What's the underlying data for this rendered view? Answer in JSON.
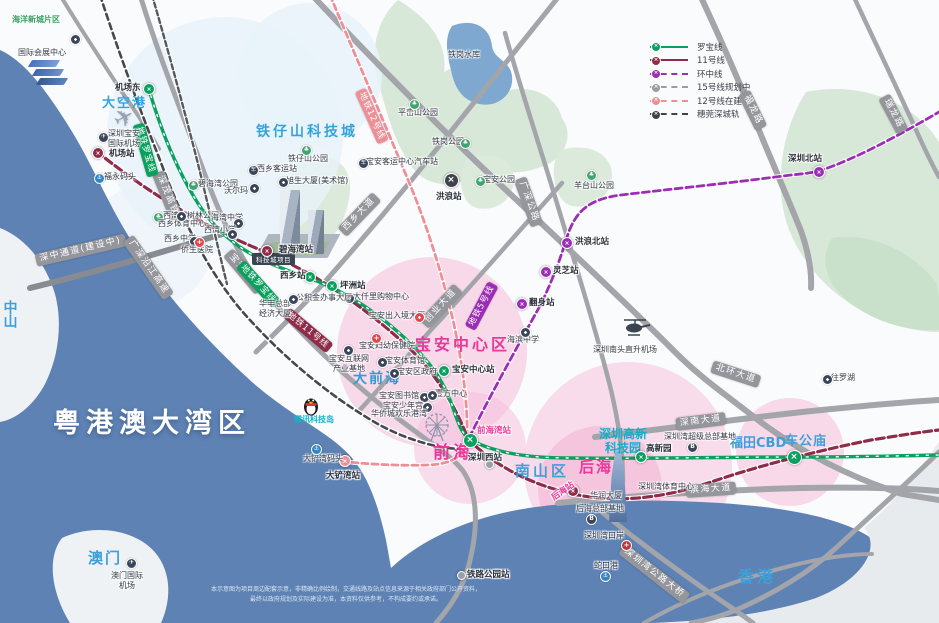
{
  "colors": {
    "sea": "#5E82B4",
    "land": "#FAFBFC",
    "terrain_green": "#D8E8D8",
    "lake": "#7FA8D0",
    "pink_zone": "#F5BEDB",
    "glow_blue": "#E9F2FA",
    "road_gray": "#A3A5AB",
    "line_colors": {
      "G": "#0BA05F",
      "M": "#8E2C49",
      "P": "#9C2EB5",
      "S": "#ED8F97",
      "D": "#3F434B",
      "R": "#9BA0A8"
    }
  },
  "legend": {
    "items": [
      {
        "label": "罗宝线",
        "color": "#0BA05F",
        "dash": "solid"
      },
      {
        "label": "11号线",
        "color": "#8E2C49",
        "dash": "solid"
      },
      {
        "label": "环中线",
        "color": "#9C2EB5",
        "dash": "dashed"
      },
      {
        "label": "15号线规划中",
        "color": "#9A9CA2",
        "dash": "dashed"
      },
      {
        "label": "12号线在建中",
        "color": "#ED8F97",
        "dash": "dashed"
      },
      {
        "label": "穗莞深城轨",
        "color": "#3F4248",
        "dash": "dashed"
      }
    ]
  },
  "areas": [
    {
      "t": "海洋新城片区",
      "x": 12,
      "y": 15,
      "s": 8,
      "c": "#3AA065"
    },
    {
      "t": "大空港",
      "x": 102,
      "y": 96,
      "s": 13,
      "c": "#35A3DB",
      "ls": 2
    },
    {
      "t": "铁仔山科技城",
      "x": 256,
      "y": 124,
      "s": 14,
      "c": "#35A3DB",
      "ls": 3
    },
    {
      "t": "宝安中心区",
      "x": 415,
      "y": 336,
      "s": 16,
      "c": "#E9399A",
      "ls": 3
    },
    {
      "t": "大前海",
      "x": 353,
      "y": 371,
      "s": 14,
      "c": "#2F9BD8",
      "ls": 2
    },
    {
      "t": "前海",
      "x": 433,
      "y": 443,
      "s": 17,
      "c": "#E9399A",
      "ls": 3
    },
    {
      "t": "南山区",
      "x": 515,
      "y": 463,
      "s": 15,
      "c": "#3FA0D8",
      "ls": 3
    },
    {
      "t": "后海",
      "x": 579,
      "y": 459,
      "s": 15,
      "c": "#E9399A",
      "ls": 2
    },
    {
      "t": "深圳高新\n科技园",
      "x": 599,
      "y": 427,
      "s": 12,
      "c": "#12AECB",
      "ctr": 1
    },
    {
      "t": "福田CBD",
      "x": 730,
      "y": 436,
      "s": 13,
      "c": "#3FA0D8"
    },
    {
      "t": "车公庙",
      "x": 785,
      "y": 434,
      "s": 13,
      "c": "#3FA0D8",
      "ls": 1
    },
    {
      "t": "香港",
      "x": 738,
      "y": 568,
      "s": 16,
      "c": "#3FA0D8",
      "ls": 3
    },
    {
      "t": "澳门",
      "x": 88,
      "y": 550,
      "s": 15,
      "c": "#3FA0D8",
      "ls": 2
    },
    {
      "t": "中山",
      "x": 1,
      "y": 300,
      "s": 14,
      "c": "#3FA0D8",
      "v": 1
    },
    {
      "t": "粤港澳大湾区",
      "x": 53,
      "y": 408,
      "s": 27,
      "c": "#FFFFFF",
      "ls": 6,
      "sh": 1
    },
    {
      "t": "腾讯科技岛",
      "x": 294,
      "y": 415,
      "s": 8,
      "c": "#17B2CC"
    }
  ],
  "road_labels": [
    {
      "t": "深中通道(建设中)",
      "x": 36,
      "y": 254,
      "r": -13
    },
    {
      "t": "广深沿江高速",
      "x": 128,
      "y": 232,
      "r": 55
    },
    {
      "t": "深茂高铁",
      "x": 158,
      "y": 166,
      "r": 68
    },
    {
      "t": "宝安大道",
      "x": 228,
      "y": 246,
      "r": 50
    },
    {
      "t": "西乡大道",
      "x": 342,
      "y": 226,
      "r": -46
    },
    {
      "t": "创业大道",
      "x": 424,
      "y": 318,
      "r": -47
    },
    {
      "t": "广深公路",
      "x": 520,
      "y": 172,
      "r": 70
    },
    {
      "t": "北环大道",
      "x": 712,
      "y": 360,
      "r": 18
    },
    {
      "t": "深南大道",
      "x": 676,
      "y": 418,
      "r": -7
    },
    {
      "t": "滨海大道",
      "x": 686,
      "y": 485,
      "r": -4
    },
    {
      "t": "福龙路",
      "x": 744,
      "y": 86,
      "r": 64
    },
    {
      "t": "瑞龙路",
      "x": 884,
      "y": 90,
      "r": 62
    },
    {
      "t": "深圳湾公路大桥",
      "x": 622,
      "y": 542,
      "r": 38
    }
  ],
  "metro_tags": [
    {
      "t": "地铁罗宝线",
      "x": 138,
      "y": 118,
      "r": 74,
      "c": "#0BA05F"
    },
    {
      "t": "地铁罗宝线",
      "x": 240,
      "y": 258,
      "r": 48,
      "c": "#0BA05F"
    },
    {
      "t": "地铁11号线",
      "x": 286,
      "y": 306,
      "r": 40,
      "c": "#8E2C49"
    },
    {
      "t": "地铁12号线",
      "x": 360,
      "y": 84,
      "r": 66,
      "c": "#ED8F97"
    },
    {
      "t": "地铁5号线",
      "x": 470,
      "y": 322,
      "r": -62,
      "c": "#9C2EB5"
    }
  ],
  "stations": [
    {
      "t": "机场东",
      "x": 148,
      "y": 88,
      "k": "G",
      "lx": 115,
      "ly": 81
    },
    {
      "t": "机场站",
      "x": 97,
      "y": 152,
      "k": "M",
      "lx": 109,
      "ly": 147
    },
    {
      "t": "碧海湾站",
      "x": 266,
      "y": 250,
      "k": "M",
      "lx": 279,
      "ly": 243
    },
    {
      "t": "西乡站",
      "x": 309,
      "y": 276,
      "k": "G",
      "lx": 280,
      "ly": 269
    },
    {
      "t": "坪洲站",
      "x": 331,
      "y": 285,
      "k": "G",
      "lx": 340,
      "ly": 279
    },
    {
      "t": "宝安中心站",
      "x": 443,
      "y": 370,
      "k": "G",
      "lx": 452,
      "ly": 363
    },
    {
      "t": "前海湾站",
      "x": 469,
      "y": 439,
      "k": "G",
      "big": 1,
      "lx": 477,
      "ly": 424,
      "lc": "#E9399A"
    },
    {
      "t": "高新园",
      "x": 640,
      "y": 456,
      "k": "G",
      "lx": 646,
      "ly": 442
    },
    {
      "t": "",
      "x": 793,
      "y": 456,
      "k": "G",
      "big": 1
    },
    {
      "t": "深圳北站",
      "x": 818,
      "y": 171,
      "k": "P",
      "lx": 788,
      "ly": 152
    },
    {
      "t": "后海站",
      "x": 572,
      "y": 490,
      "k": "M",
      "lx": 552,
      "ly": 492,
      "lc": "#E9399A",
      "lr": -35
    },
    {
      "t": "深圳西站",
      "x": 488,
      "y": 463,
      "k": "R",
      "lx": 468,
      "ly": 451
    },
    {
      "t": "洪浪北站",
      "x": 566,
      "y": 242,
      "k": "P",
      "lx": 575,
      "ly": 235
    },
    {
      "t": "灵芝站",
      "x": 545,
      "y": 271,
      "k": "P",
      "lx": 553,
      "ly": 264
    },
    {
      "t": "翻身站",
      "x": 521,
      "y": 303,
      "k": "P",
      "lx": 529,
      "ly": 296
    },
    {
      "t": "洪浪站",
      "x": 450,
      "y": 179,
      "k": "D",
      "big": 1,
      "lx": 436,
      "ly": 190
    },
    {
      "t": "大铲湾站",
      "x": 344,
      "y": 460,
      "k": "S",
      "lx": 326,
      "ly": 469
    },
    {
      "t": "铁路公园站",
      "x": 460,
      "y": 574,
      "k": "R",
      "lx": 467,
      "ly": 568
    }
  ],
  "pois": [
    {
      "t": "国际会展中心",
      "x": 18,
      "y": 48,
      "i": "dot",
      "ix": 70,
      "iy": 34
    },
    {
      "t": "深圳宝安\n国际机场",
      "x": 108,
      "y": 129,
      "ctr": 1,
      "i": "star",
      "ix": 98,
      "iy": 132
    },
    {
      "i": "plane",
      "ix": 114,
      "iy": 104
    },
    {
      "t": "福永码头",
      "x": 104,
      "y": 172,
      "i": "anchor",
      "ix": 94,
      "iy": 173
    },
    {
      "t": "碧海湾公园",
      "x": 198,
      "y": 179,
      "i": "park",
      "ix": 188,
      "iy": 180
    },
    {
      "t": "沃尔玛",
      "x": 224,
      "y": 186,
      "i": "dot",
      "ix": 249,
      "iy": 183
    },
    {
      "t": "西湾红树林公园",
      "x": 163,
      "y": 211,
      "i": "park",
      "ix": 153,
      "iy": 212
    },
    {
      "t": "海湾中学",
      "x": 211,
      "y": 213,
      "i": "dot",
      "ix": 233,
      "iy": 218
    },
    {
      "t": "西湾小学",
      "x": 204,
      "y": 225,
      "i": "dot",
      "ix": 227,
      "iy": 229
    },
    {
      "t": "西乡体育中心",
      "x": 158,
      "y": 219,
      "i": "dot",
      "ix": 176,
      "iy": 211
    },
    {
      "t": "西乡中学",
      "x": 164,
      "y": 234,
      "i": "dot",
      "ix": 189,
      "iy": 236
    },
    {
      "t": "侨生医院",
      "x": 181,
      "y": 245,
      "i": "hosp",
      "ix": 194,
      "iy": 237
    },
    {
      "t": "西乡客运站",
      "x": 257,
      "y": 164,
      "i": "bus",
      "ix": 248,
      "iy": 165
    },
    {
      "t": "旭生大厦(美术馆)",
      "x": 286,
      "y": 176,
      "i": "dot",
      "ix": 278,
      "iy": 177
    },
    {
      "t": "铁仔山公园",
      "x": 288,
      "y": 154,
      "i": "park",
      "ix": 301,
      "iy": 145
    },
    {
      "t": "平峦山公园",
      "x": 398,
      "y": 108,
      "i": "park",
      "ix": 409,
      "iy": 99
    },
    {
      "t": "铁岗公园",
      "x": 432,
      "y": 137,
      "i": "park",
      "ix": 460,
      "iy": 138
    },
    {
      "t": "铁岗水库",
      "x": 448,
      "y": 50
    },
    {
      "t": "宝安公园",
      "x": 483,
      "y": 175,
      "i": "park",
      "ix": 475,
      "iy": 176
    },
    {
      "t": "羊台山公园",
      "x": 574,
      "y": 181,
      "i": "park",
      "ix": 586,
      "iy": 170
    },
    {
      "t": "宝安客运中心汽车站",
      "x": 366,
      "y": 157,
      "i": "bus",
      "ix": 358,
      "iy": 158
    },
    {
      "t": "大仟里购物中心",
      "x": 353,
      "y": 292,
      "i": "dot",
      "ix": 344,
      "iy": 293
    },
    {
      "t": "宝安出入境大厅",
      "x": 369,
      "y": 311,
      "i": "reddot",
      "ix": 414,
      "iy": 312
    },
    {
      "t": "宝安妇幼保健院",
      "x": 359,
      "y": 341,
      "i": "hosp",
      "ix": 371,
      "iy": 333
    },
    {
      "t": "宝安互联网\n产业基地",
      "x": 329,
      "y": 354,
      "ctr": 1,
      "i": "dot",
      "ix": 343,
      "iy": 345
    },
    {
      "t": "宝安体育馆",
      "x": 385,
      "y": 356,
      "i": "dot",
      "ix": 377,
      "iy": 357
    },
    {
      "t": "宝安区政府",
      "x": 397,
      "y": 367,
      "i": "dot",
      "ix": 389,
      "iy": 368
    },
    {
      "t": "宝安图书馆",
      "x": 379,
      "y": 391,
      "i": "dot",
      "ix": 419,
      "iy": 392
    },
    {
      "t": "宝安少年宫",
      "x": 383,
      "y": 401,
      "i": "dot",
      "ix": 422,
      "iy": 402
    },
    {
      "t": "华侨城欢乐港湾",
      "x": 371,
      "y": 409
    },
    {
      "t": "壹方中心",
      "x": 435,
      "y": 389,
      "i": "dot",
      "ix": 427,
      "iy": 390
    },
    {
      "t": "海滨中学",
      "x": 507,
      "y": 335,
      "i": "dot",
      "ix": 520,
      "iy": 327
    },
    {
      "t": "深圳南头直升机场",
      "x": 593,
      "y": 345,
      "i": "heli",
      "ix": 622,
      "iy": 316
    },
    {
      "i": "penguin",
      "ix": 303,
      "iy": 395
    },
    {
      "i": "wheel",
      "ix": 421,
      "iy": 411
    },
    {
      "t": "大铲湾码头",
      "x": 303,
      "y": 454,
      "i": "anchor",
      "ix": 311,
      "iy": 444
    },
    {
      "t": "深圳湾超级总部基地",
      "x": 664,
      "y": 432,
      "i": "hq",
      "ix": 687,
      "iy": 442
    },
    {
      "t": "深圳湾体育中心",
      "x": 638,
      "y": 482
    },
    {
      "t": "华润大厦",
      "x": 590,
      "y": 491
    },
    {
      "t": "后海总部基地",
      "x": 576,
      "y": 504,
      "i": "hq",
      "ix": 586,
      "iy": 514
    },
    {
      "t": "深圳湾口岸",
      "x": 584,
      "y": 531,
      "i": "port",
      "ix": 621,
      "iy": 540
    },
    {
      "t": "蛇口港",
      "x": 594,
      "y": 561,
      "i": "anchor",
      "ix": 600,
      "iy": 571
    },
    {
      "t": "澳门国际\n机场",
      "x": 111,
      "y": 571,
      "ctr": 1,
      "i": "star",
      "ix": 126,
      "iy": 558
    },
    {
      "t": "往罗湖",
      "x": 831,
      "y": 373,
      "i": "dot",
      "ix": 822,
      "iy": 374
    },
    {
      "t": "华丰总部\n经济大厦",
      "x": 259,
      "y": 299,
      "ctr": 1
    },
    {
      "t": "公积金办事大厅",
      "x": 296,
      "y": 293,
      "i": "dot",
      "ix": 288,
      "iy": 294
    }
  ],
  "project_label": "科技城项目",
  "disclaimer": "本示意图为项目周边配套示意，非精确比例绘制，交通线路及站点信息来源于相关政府部门公开资料，\n最终以政府规划及实际建设为准，本资料仅供参考，不构成要约或承诺。"
}
